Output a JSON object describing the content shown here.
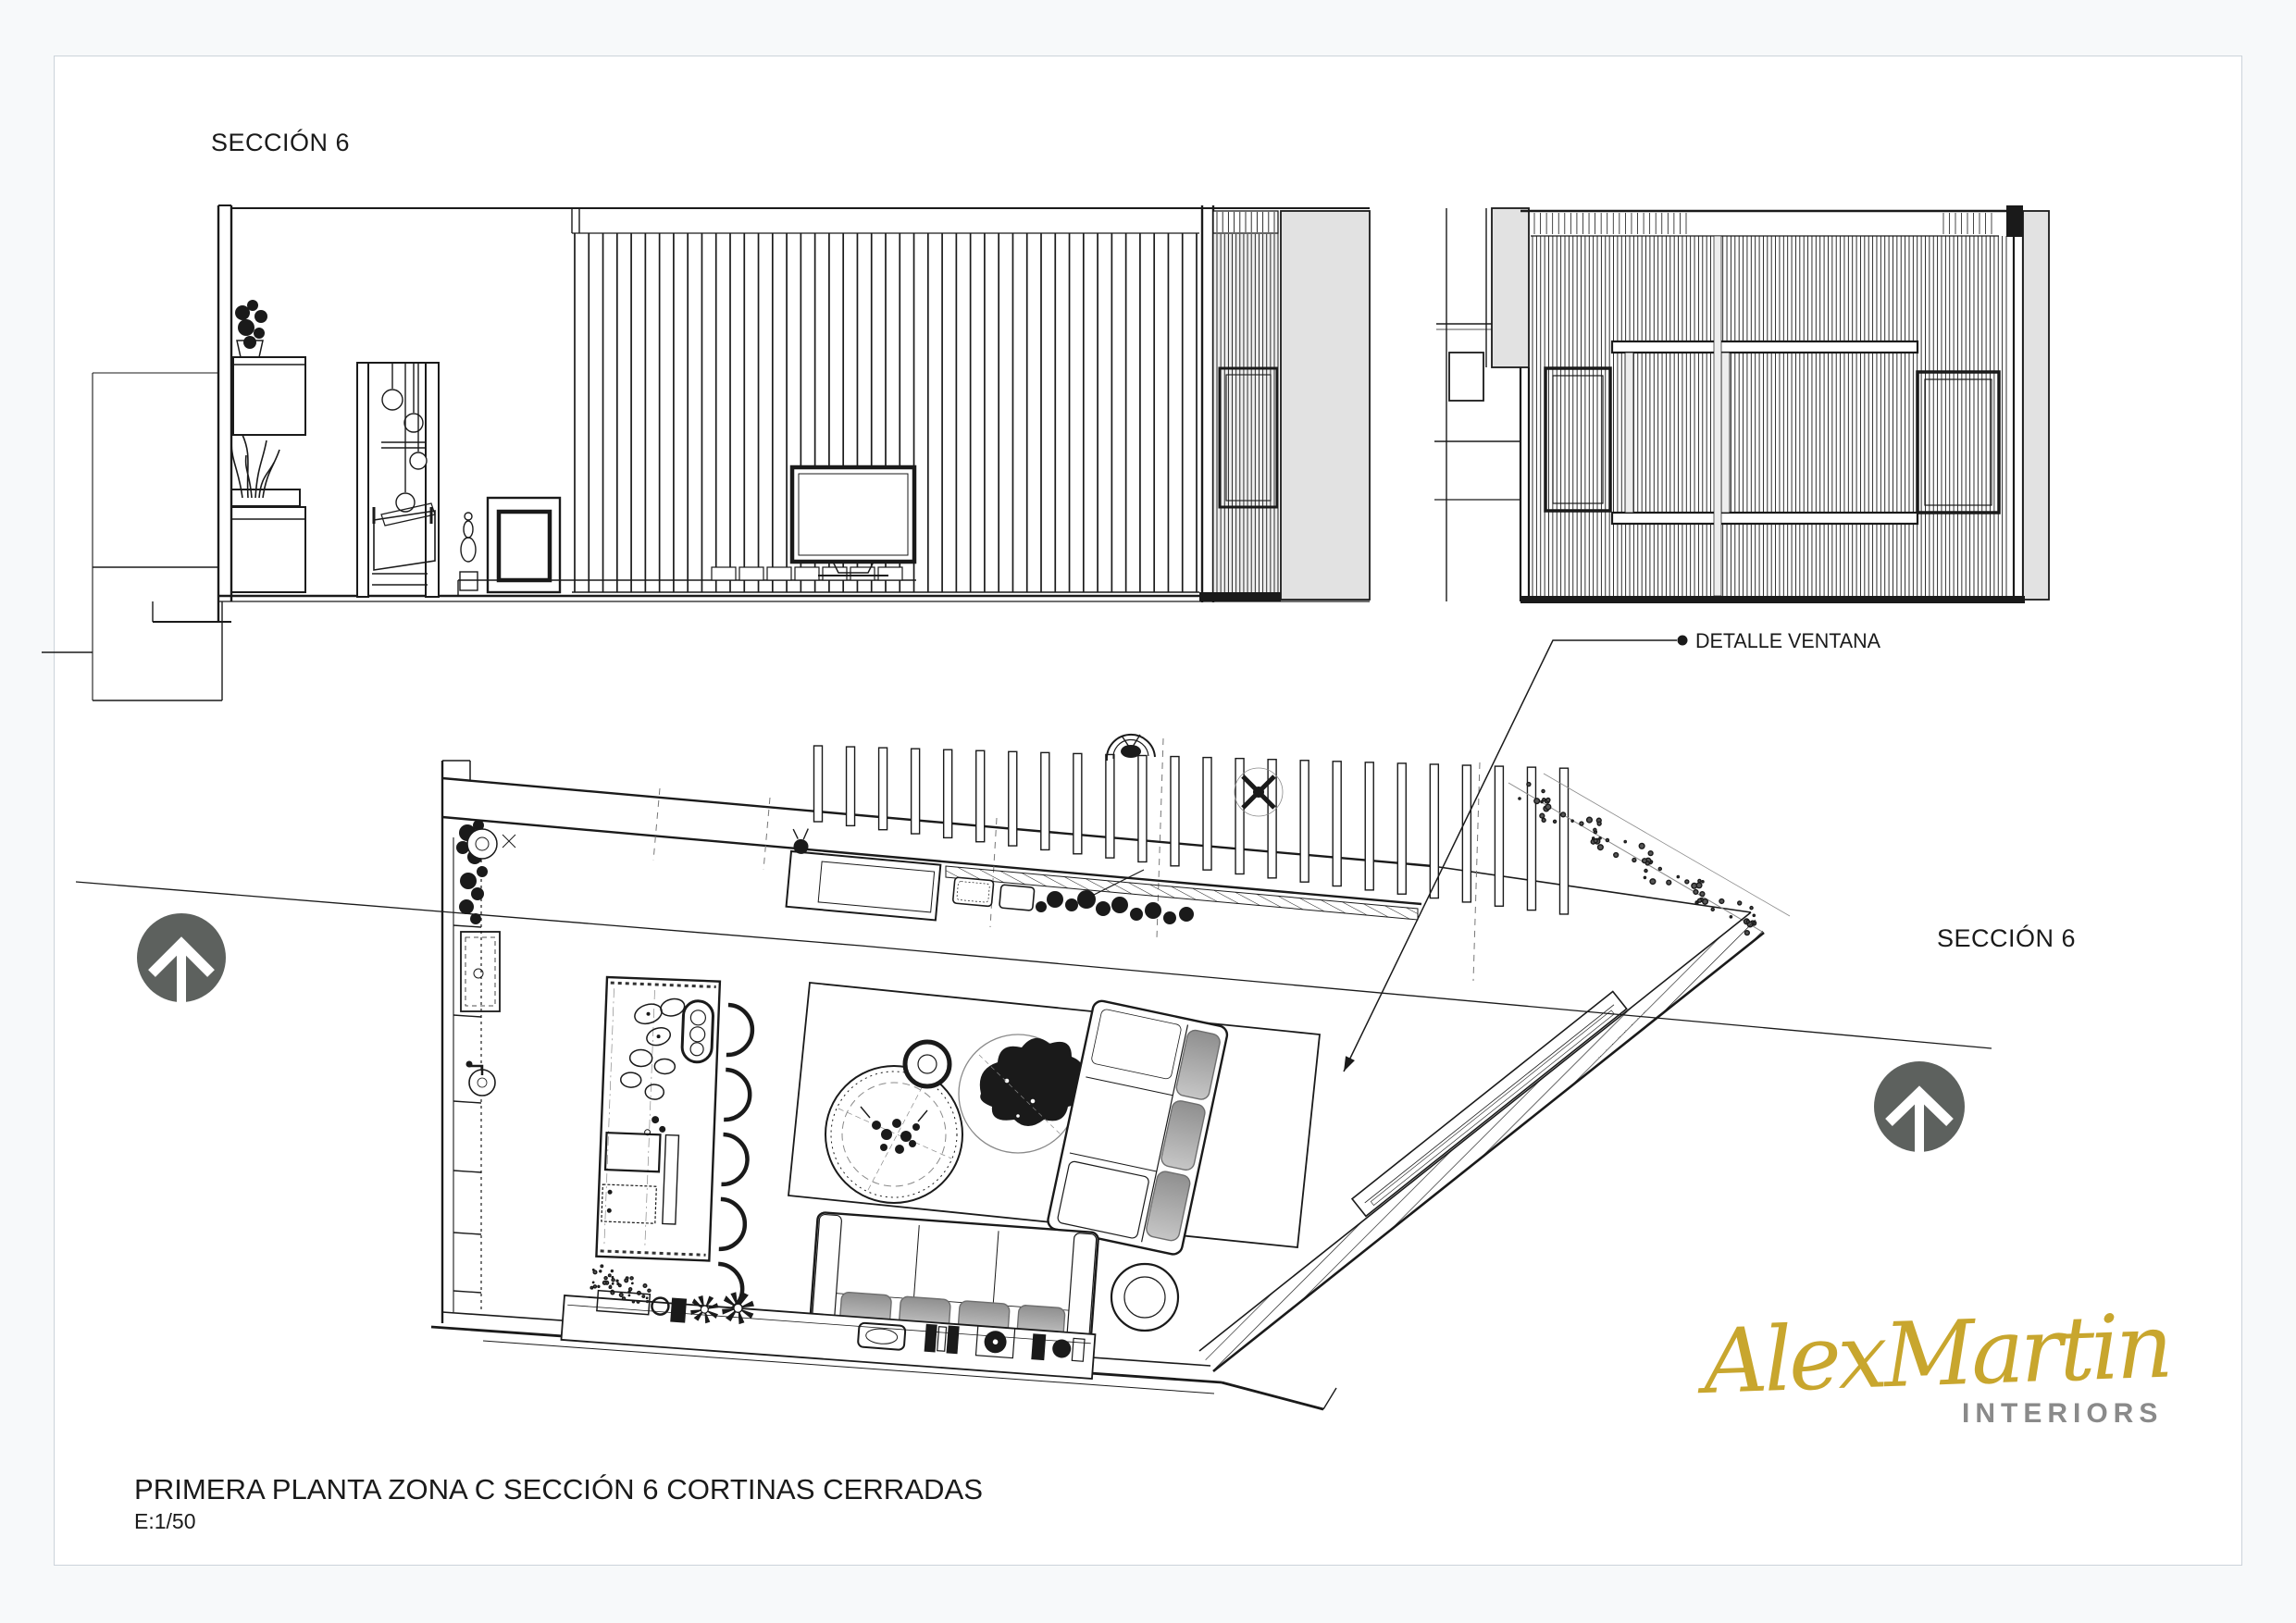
{
  "labels": {
    "section_top": "SECCIÓN 6",
    "section_right": "SECCIÓN 6",
    "detail_window": "DETALLE VENTANA",
    "title": "PRIMERA PLANTA ZONA C SECCIÓN 6 CORTINAS CERRADAS",
    "scale": "E:1/50"
  },
  "logo": {
    "name": "AlexMartin",
    "subtitle": "INTERIORS"
  },
  "colors": {
    "line": "#1a1a1a",
    "wall_gray": "#e2e2e2",
    "panel_gray": "#ededed",
    "cushion": "#a9a9a9",
    "compass": "#5d615e",
    "section_line": "#3f3f3f",
    "logo_gold": "#c8a62e",
    "logo_gray": "#8a8a8a",
    "page_bg": "#f7f9fa",
    "sheet_border": "#ccd3da"
  },
  "icons": [
    "north-arrow-icon",
    "leader-bullet-icon",
    "leader-arrow-icon"
  ]
}
